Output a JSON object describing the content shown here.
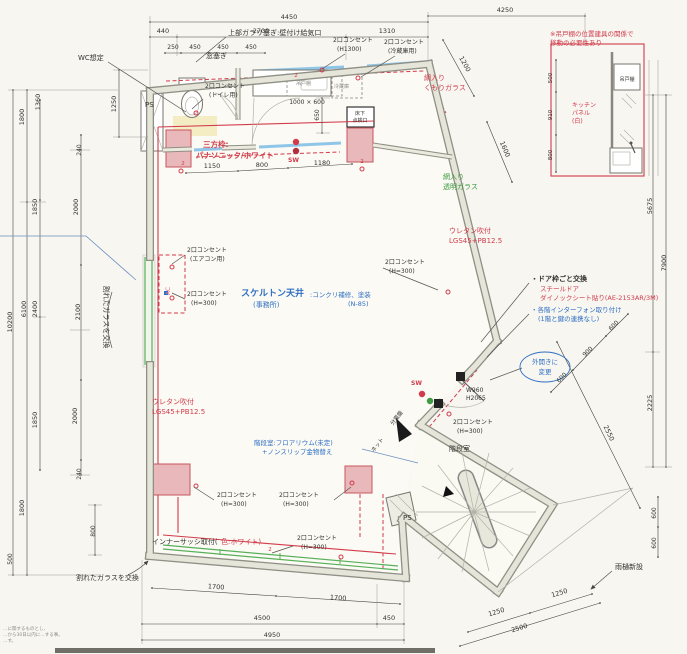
{
  "meta": {
    "type": "architectural-floor-plan",
    "language": "ja"
  },
  "colors": {
    "k": "#33332f",
    "r": "#d23b4a",
    "b": "#2f6fc4",
    "g": "#3a9a3c",
    "p": "#e2708a",
    "gy": "#8c8c84"
  },
  "labels": [
    {
      "t": "4450",
      "x": 289,
      "y": 19
    },
    {
      "t": "440",
      "x": 163,
      "y": 33
    },
    {
      "t": "2700",
      "x": 261,
      "y": 33
    },
    {
      "t": "1310",
      "x": 387,
      "y": 33
    },
    {
      "t": "250",
      "x": 173,
      "y": 49,
      "s": 6
    },
    {
      "t": "450",
      "x": 195,
      "y": 49,
      "s": 6
    },
    {
      "t": "450",
      "x": 223,
      "y": 49,
      "s": 6
    },
    {
      "t": "450",
      "x": 251,
      "y": 49,
      "s": 6
    },
    {
      "t": "4250",
      "x": 505,
      "y": 12
    },
    {
      "t": "1200",
      "x": 463,
      "y": 65,
      "r": 61
    },
    {
      "t": "1600",
      "x": 503,
      "y": 150,
      "r": 67
    },
    {
      "t": "1150",
      "x": 212,
      "y": 168
    },
    {
      "t": "800",
      "x": 262,
      "y": 167
    },
    {
      "t": "1180",
      "x": 322,
      "y": 165
    },
    {
      "t": "1000 × 600",
      "x": 307,
      "y": 104,
      "s": 6
    },
    {
      "t": "650",
      "x": 319,
      "y": 115,
      "r": -90,
      "s": 6
    },
    {
      "t": "1250",
      "x": 116,
      "y": 104,
      "r": -90
    },
    {
      "t": "1800",
      "x": 24,
      "y": 117,
      "r": -90
    },
    {
      "t": "1360",
      "x": 40,
      "y": 102,
      "r": -90
    },
    {
      "t": "240",
      "x": 81,
      "y": 150,
      "r": -90,
      "s": 6
    },
    {
      "t": "1850",
      "x": 37,
      "y": 207,
      "r": -90
    },
    {
      "t": "2000",
      "x": 78,
      "y": 207,
      "r": -90
    },
    {
      "t": "6100",
      "x": 26,
      "y": 309,
      "r": -90
    },
    {
      "t": "2400",
      "x": 37,
      "y": 309,
      "r": -90
    },
    {
      "t": "2100",
      "x": 80,
      "y": 312,
      "r": -90
    },
    {
      "t": "10200",
      "x": 12,
      "y": 322,
      "r": -90
    },
    {
      "t": "1850",
      "x": 37,
      "y": 420,
      "r": -90
    },
    {
      "t": "2000",
      "x": 77,
      "y": 416,
      "r": -90
    },
    {
      "t": "240",
      "x": 81,
      "y": 474,
      "r": -90,
      "s": 6
    },
    {
      "t": "1800",
      "x": 24,
      "y": 508,
      "r": -90
    },
    {
      "t": "800",
      "x": 95,
      "y": 531,
      "r": -90,
      "s": 6
    },
    {
      "t": "500",
      "x": 12,
      "y": 559,
      "r": -90,
      "s": 6
    },
    {
      "t": "5675",
      "x": 652,
      "y": 206,
      "r": -90
    },
    {
      "t": "7900",
      "x": 666,
      "y": 263,
      "r": -90
    },
    {
      "t": "2225",
      "x": 652,
      "y": 403,
      "r": -90
    },
    {
      "t": "2550",
      "x": 607,
      "y": 434,
      "r": 64
    },
    {
      "t": "600",
      "x": 615,
      "y": 327,
      "r": -45,
      "s": 6
    },
    {
      "t": "900",
      "x": 589,
      "y": 353,
      "r": -45,
      "s": 6
    },
    {
      "t": "600",
      "x": 563,
      "y": 379,
      "r": -45,
      "s": 6
    },
    {
      "t": "600",
      "x": 656,
      "y": 513,
      "r": -90,
      "s": 6
    },
    {
      "t": "600",
      "x": 656,
      "y": 543,
      "r": -90,
      "s": 6
    },
    {
      "t": "1700",
      "x": 216,
      "y": 589,
      "r": 4
    },
    {
      "t": "1700",
      "x": 338,
      "y": 600,
      "r": 4
    },
    {
      "t": "4500",
      "x": 262,
      "y": 620
    },
    {
      "t": "450",
      "x": 389,
      "y": 620
    },
    {
      "t": "4950",
      "x": 272,
      "y": 637
    },
    {
      "t": "1250",
      "x": 497,
      "y": 614,
      "r": -17
    },
    {
      "t": "1250",
      "x": 560,
      "y": 595,
      "r": -17
    },
    {
      "t": "2500",
      "x": 520,
      "y": 630,
      "r": -17
    },
    {
      "t": "500",
      "x": 552,
      "y": 78,
      "r": -90,
      "s": 5.5
    },
    {
      "t": "910",
      "x": 552,
      "y": 115,
      "r": -90,
      "s": 5.5
    },
    {
      "t": "800",
      "x": 552,
      "y": 155,
      "r": -90,
      "s": 5.5
    },
    {
      "t": "W960",
      "x": 466,
      "y": 392,
      "a": "s",
      "s": 6
    },
    {
      "t": "H2065",
      "x": 466,
      "y": 400,
      "a": "s",
      "s": 6
    },
    {
      "t": "WC想定",
      "x": 78,
      "y": 60,
      "a": "s",
      "s": 7,
      "n": "note-wc"
    },
    {
      "t": "上部ガラリ塞ぎ:壁付け給気口",
      "x": 228,
      "y": 35,
      "a": "s",
      "s": 7,
      "n": "note-gallery-close"
    },
    {
      "t": "窓塞ぎ",
      "x": 206,
      "y": 58,
      "a": "s",
      "s": 7,
      "n": "note-window-close"
    },
    {
      "t": "2口コンセント",
      "x": 333,
      "y": 42,
      "a": "s",
      "s": 6,
      "n": "outlet-label"
    },
    {
      "t": "(H1300)",
      "x": 337,
      "y": 51,
      "a": "s",
      "s": 6
    },
    {
      "t": "2口コンセント",
      "x": 384,
      "y": 44,
      "a": "s",
      "s": 6,
      "n": "outlet-label"
    },
    {
      "t": "(冷蔵庫用)",
      "x": 388,
      "y": 53,
      "a": "s",
      "s": 6
    },
    {
      "t": "2口コンセント",
      "x": 205,
      "y": 88,
      "a": "s",
      "s": 6,
      "n": "outlet-label"
    },
    {
      "t": "(トイレ用)",
      "x": 209,
      "y": 97,
      "a": "s",
      "s": 6
    },
    {
      "t": "三方枠:",
      "x": 203,
      "y": 147,
      "a": "s",
      "s": 7.5,
      "c": "r",
      "w": "bold",
      "n": "note-door-frame"
    },
    {
      "t": "パナソニック/ホワイト",
      "x": 196,
      "y": 158,
      "a": "s",
      "s": 7.5,
      "c": "r",
      "w": "bold"
    },
    {
      "t": "SW",
      "x": 288,
      "y": 162,
      "a": "s",
      "s": 6,
      "c": "r",
      "w": "bold",
      "n": "switch-label"
    },
    {
      "t": "吊戸棚",
      "x": 296,
      "y": 85,
      "a": "s",
      "s": 5,
      "c": "gy"
    },
    {
      "t": "冷蔵庫",
      "x": 334,
      "y": 88,
      "a": "s",
      "s": 5,
      "c": "gy"
    },
    {
      "t": "床下",
      "x": 360,
      "y": 115,
      "s": 5
    },
    {
      "t": "点検口",
      "x": 360,
      "y": 122,
      "s": 5
    },
    {
      "t": "網入り",
      "x": 424,
      "y": 80,
      "a": "s",
      "s": 7,
      "c": "r"
    },
    {
      "t": "くもりガラス",
      "x": 424,
      "y": 90,
      "a": "s",
      "s": 7,
      "c": "r"
    },
    {
      "t": "網入り",
      "x": 443,
      "y": 179,
      "a": "s",
      "s": 7,
      "c": "g"
    },
    {
      "t": "透明ガラス",
      "x": 443,
      "y": 189,
      "a": "s",
      "s": 7,
      "c": "g"
    },
    {
      "t": "ウレタン吹付",
      "x": 449,
      "y": 233,
      "a": "s",
      "s": 7,
      "c": "r"
    },
    {
      "t": "LGS45+PB12.5",
      "x": 449,
      "y": 243,
      "a": "s",
      "s": 7,
      "c": "r"
    },
    {
      "t": "2口コンセント",
      "x": 385,
      "y": 264,
      "a": "s",
      "s": 6,
      "n": "outlet-label"
    },
    {
      "t": "(H=300)",
      "x": 389,
      "y": 273,
      "a": "s",
      "s": 6
    },
    {
      "t": "・ドア枠ごと交換",
      "x": 531,
      "y": 281,
      "a": "s",
      "s": 7,
      "w": "bold",
      "n": "note-door-replace"
    },
    {
      "t": "スチールドア",
      "x": 540,
      "y": 291,
      "a": "s",
      "s": 6.5,
      "c": "r"
    },
    {
      "t": "ダイノックシート貼り(AE-2153AR/3M)",
      "x": 540,
      "y": 300,
      "a": "s",
      "s": 6.5,
      "c": "r"
    },
    {
      "t": "・各階インターフォン取り付け",
      "x": 531,
      "y": 312,
      "a": "s",
      "s": 6.5,
      "c": "b",
      "n": "note-intercom"
    },
    {
      "t": "(1階と鍵の連携なし)",
      "x": 538,
      "y": 321,
      "a": "s",
      "s": 6.5,
      "c": "b"
    },
    {
      "t": "外開きに",
      "x": 545,
      "y": 364,
      "s": 6.5,
      "c": "b",
      "n": "note-door-outswing"
    },
    {
      "t": "変更",
      "x": 545,
      "y": 374,
      "s": 6.5,
      "c": "b"
    },
    {
      "t": "スケルトン天井",
      "x": 241,
      "y": 296,
      "a": "s",
      "s": 9,
      "c": "b",
      "w": "bold",
      "n": "room-label-office-ceiling"
    },
    {
      "t": "(事務所)",
      "x": 253,
      "y": 307,
      "a": "s",
      "s": 7,
      "c": "b",
      "n": "room-label-office"
    },
    {
      "t": ":コンクリ補修、塗装",
      "x": 310,
      "y": 297,
      "a": "s",
      "s": 6.5,
      "c": "b"
    },
    {
      "t": "(N-85)",
      "x": 348,
      "y": 306,
      "a": "s",
      "s": 6.5,
      "c": "b"
    },
    {
      "t": "2口コンセント",
      "x": 187,
      "y": 252,
      "a": "s",
      "s": 6,
      "n": "outlet-label"
    },
    {
      "t": "(エアコン用)",
      "x": 190,
      "y": 261,
      "a": "s",
      "s": 6
    },
    {
      "t": "2口コンセント",
      "x": 187,
      "y": 296,
      "a": "s",
      "s": 6,
      "n": "outlet-label"
    },
    {
      "t": "(H=300)",
      "x": 191,
      "y": 305,
      "a": "s",
      "s": 6
    },
    {
      "t": "AC",
      "x": 170,
      "y": 291,
      "s": 6,
      "c": "p",
      "r": -90,
      "n": "ac-unit-label"
    },
    {
      "t": "割れたガラスを交換",
      "x": 104,
      "y": 317,
      "s": 7,
      "r": 90,
      "n": "note-broken-glass"
    },
    {
      "t": "割れたガラスを交換",
      "x": 76,
      "y": 580,
      "a": "s",
      "s": 7,
      "n": "note-broken-glass-2"
    },
    {
      "t": "ウレタン吹付",
      "x": 152,
      "y": 404,
      "a": "s",
      "s": 7,
      "c": "r"
    },
    {
      "t": "LGS45+PB12.5",
      "x": 152,
      "y": 414,
      "a": "s",
      "s": 7,
      "c": "r"
    },
    {
      "t": "階段室:フロアリウム(未定)",
      "x": 254,
      "y": 445,
      "a": "s",
      "s": 6.5,
      "c": "b",
      "n": "note-stair-floor"
    },
    {
      "t": "+ノンスリップ金物替え",
      "x": 262,
      "y": 454,
      "a": "s",
      "s": 6.5,
      "c": "b"
    },
    {
      "t": "2口コンセント",
      "x": 217,
      "y": 497,
      "a": "s",
      "s": 6,
      "n": "outlet-label"
    },
    {
      "t": "(H=300)",
      "x": 221,
      "y": 506,
      "a": "s",
      "s": 6
    },
    {
      "t": "2口コンセント",
      "x": 279,
      "y": 497,
      "a": "s",
      "s": 6,
      "n": "outlet-label"
    },
    {
      "t": "(H=300)",
      "x": 283,
      "y": 506,
      "a": "s",
      "s": 6
    },
    {
      "t": "2口コンセント",
      "x": 297,
      "y": 540,
      "a": "s",
      "s": 6,
      "n": "outlet-label"
    },
    {
      "t": "(H=300)",
      "x": 301,
      "y": 549,
      "a": "s",
      "s": 6
    },
    {
      "t": "インナーサッシ取付(",
      "x": 152,
      "y": 544,
      "a": "s",
      "s": 7,
      "n": "note-inner-sash"
    },
    {
      "t": "色:ホワイト)",
      "x": 221,
      "y": 544,
      "a": "s",
      "s": 7,
      "c": "r"
    },
    {
      "t": "分電盤",
      "x": 398,
      "y": 419,
      "s": 5.5,
      "r": -52,
      "n": "label-distribution-board"
    },
    {
      "t": "ネット",
      "x": 379,
      "y": 446,
      "s": 5.5,
      "r": -52
    },
    {
      "t": "SW",
      "x": 411,
      "y": 385,
      "a": "s",
      "s": 6,
      "c": "r",
      "w": "bold",
      "n": "switch-label"
    },
    {
      "t": "2口コンセント",
      "x": 453,
      "y": 424,
      "a": "s",
      "s": 6,
      "n": "outlet-label"
    },
    {
      "t": "(H=300)",
      "x": 457,
      "y": 433,
      "a": "s",
      "s": 6
    },
    {
      "t": "階段室",
      "x": 449,
      "y": 451,
      "a": "s",
      "s": 7,
      "n": "room-label-stairwell"
    },
    {
      "t": "PS",
      "x": 403,
      "y": 520,
      "a": "s",
      "s": 7,
      "n": "shaft-label"
    },
    {
      "t": "PS",
      "x": 145,
      "y": 107,
      "a": "s",
      "s": 7,
      "n": "shaft-label"
    },
    {
      "t": "雨樋新設",
      "x": 615,
      "y": 569,
      "a": "s",
      "s": 7,
      "n": "note-downspout"
    },
    {
      "t": "※吊戸棚の位置建具の関係で",
      "x": 550,
      "y": 36,
      "a": "s",
      "s": 6.5,
      "c": "r",
      "n": "note-cabinet-move"
    },
    {
      "t": "移動の必要性あり",
      "x": 550,
      "y": 45,
      "a": "s",
      "s": 6.5,
      "c": "r"
    },
    {
      "t": "吊戸棚",
      "x": 627,
      "y": 81,
      "s": 5
    },
    {
      "t": "キッチン",
      "x": 572,
      "y": 107,
      "a": "s",
      "s": 6,
      "c": "r",
      "n": "note-kitchen-panel"
    },
    {
      "t": "パネル",
      "x": 572,
      "y": 115,
      "a": "s",
      "s": 6,
      "c": "r"
    },
    {
      "t": "(白)",
      "x": 572,
      "y": 123,
      "a": "s",
      "s": 6,
      "c": "r"
    },
    {
      "t": "2",
      "x": 183,
      "y": 165,
      "s": 5.5,
      "c": "r"
    },
    {
      "t": "2",
      "x": 296,
      "y": 77,
      "s": 5.5,
      "c": "r"
    },
    {
      "t": "2",
      "x": 362,
      "y": 163,
      "s": 5.5,
      "c": "r"
    },
    {
      "t": "2",
      "x": 270,
      "y": 551,
      "s": 5.5,
      "c": "r"
    },
    {
      "t": "…に関するものとし、",
      "x": 3,
      "y": 630,
      "a": "s",
      "s": 4.5,
      "c": "gy",
      "n": "footnote-line"
    },
    {
      "t": "…から30日以内に…する事。",
      "x": 3,
      "y": 636,
      "a": "s",
      "s": 4.5,
      "c": "gy",
      "n": "footnote-line"
    },
    {
      "t": "…す。",
      "x": 3,
      "y": 642,
      "a": "s",
      "s": 4.5,
      "c": "gy",
      "n": "footnote-line"
    }
  ]
}
